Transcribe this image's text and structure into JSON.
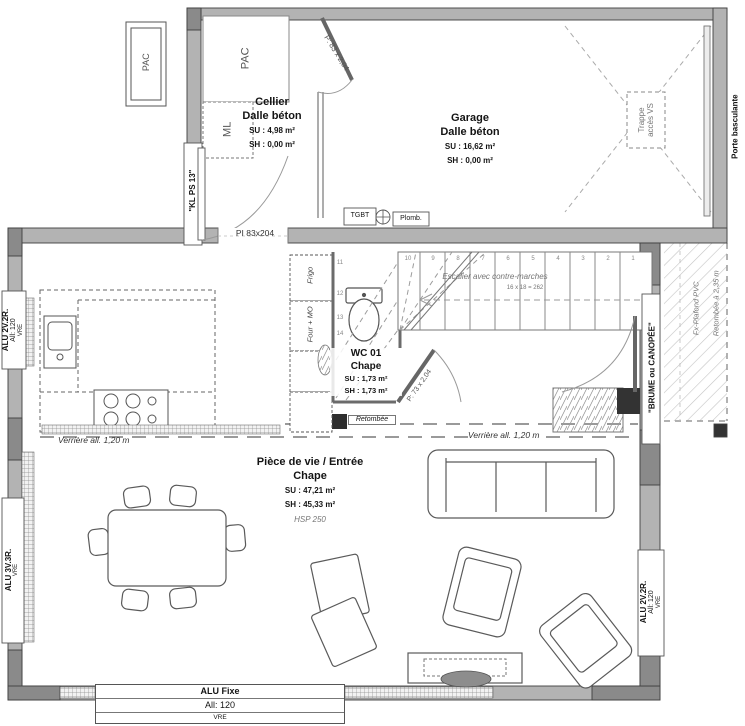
{
  "rooms": {
    "cellier": {
      "name": "Cellier",
      "floor": "Dalle béton",
      "su": "SU : 4,98 m²",
      "sh": "SH : 0,00 m²"
    },
    "garage": {
      "name": "Garage",
      "floor": "Dalle béton",
      "su": "SU : 16,62 m²",
      "sh": "SH : 0,00 m²"
    },
    "wc": {
      "name": "WC 01",
      "floor": "Chape",
      "su": "SU : 1,73 m²",
      "sh": "SH : 1,73 m²"
    },
    "living": {
      "name": "Pièce de vie / Entrée",
      "floor": "Chape",
      "su": "SU : 47,21 m²",
      "sh": "SH : 45,33 m²",
      "hsp": "HSP 250"
    }
  },
  "equipment": {
    "pac_out": "PAC",
    "pac_in": "PAC",
    "ml": "ML",
    "frigo": "Frigo",
    "four": "Four + MO",
    "tgbt": "TGBT",
    "plomb": "Plomb.",
    "trappe_l1": "Trappe",
    "trappe_l2": "accès VS",
    "porte_basculante": "Porte basculante"
  },
  "doors": {
    "door_garage": "P: 83 x 2,04",
    "door_wc": "P: 73 x 2,04",
    "door_cellier": "\"KL PS 13\"",
    "passage": "PI 83x204"
  },
  "windows": {
    "left_upper": {
      "l1": "ALU 2V.2R.",
      "l2": "All: 120",
      "l3": "VRE"
    },
    "left_lower": {
      "l1": "ALU 3V.3R.",
      "l2": "VRE"
    },
    "bottom": {
      "l1": "ALU Fixe",
      "l2": "All: 120",
      "l3": "VRE"
    },
    "right_lower": {
      "l1": "ALU 2V.2R.",
      "l2": "All: 120",
      "l3": "VRE"
    },
    "bay": "\"BRUME ou CANOPÉE\""
  },
  "terrace": {
    "ceiling": "Fx-Plafond PVC",
    "drop": "Retombée à 2,35 m"
  },
  "stairs": {
    "label": "Escalier avec contre-marches",
    "formula": "16 x 18 = 262",
    "tread_numbers": [
      "10",
      "9",
      "8",
      "7",
      "6",
      "5",
      "4",
      "3",
      "2",
      "1"
    ],
    "winder_numbers": [
      "11",
      "12",
      "13",
      "14"
    ]
  },
  "annotations": {
    "verriere_left": "Verrière all. 1,20 m",
    "verriere_right": "Verrière all. 1,20 m",
    "retombee": "Retombée"
  }
}
